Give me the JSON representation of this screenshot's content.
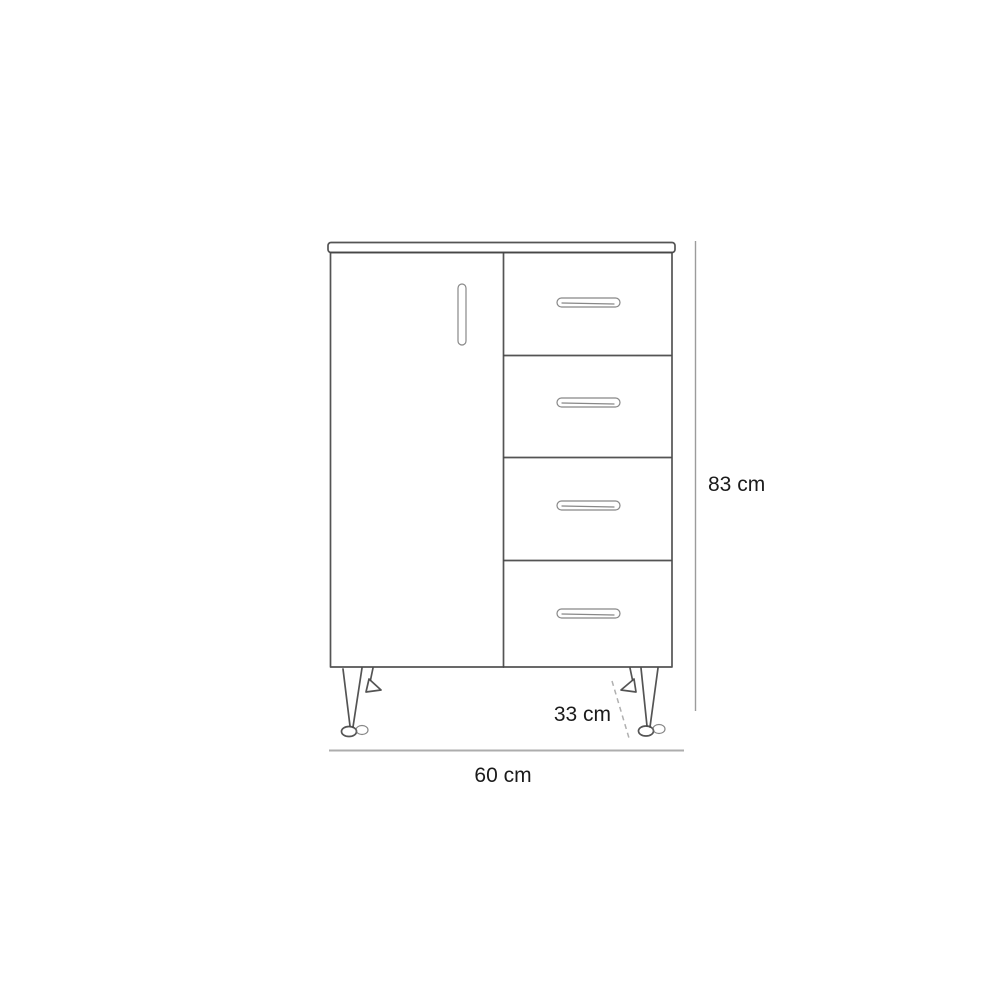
{
  "figure": {
    "kind": "furniture-dimension-diagram",
    "subject": "cabinet with one door, four drawers and tapered legs",
    "drawer_count": 4,
    "door_count": 1
  },
  "dimensions": {
    "height_label": "83 cm",
    "width_label": "60 cm",
    "depth_label": "33 cm"
  },
  "colors": {
    "background": "#ffffff",
    "ink": "#454545",
    "dimension_line": "#9c9c9c",
    "label_text": "#1b1b1b"
  }
}
